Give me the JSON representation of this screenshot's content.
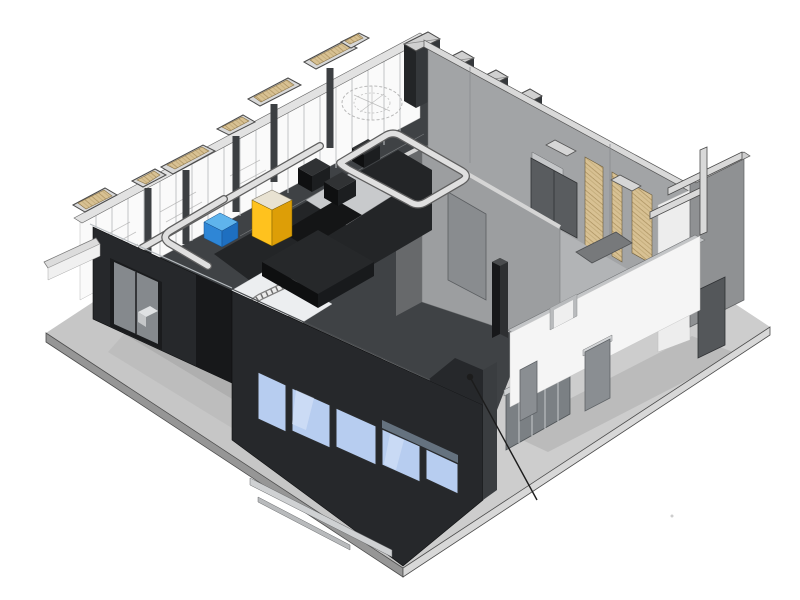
{
  "scene": {
    "aria_label": "3D axonometric cutaway rendering of a single-story commercial building interior with sectioned walls, ductwork, kitchen equipment and storefront",
    "annotation_label": ""
  },
  "colors": {
    "background": "#ffffff",
    "ground": "#c6c6c6",
    "ground_edge_front": "#969696",
    "ground_edge_right": "#d8d8d8",
    "ground_shadow": "#aaaaaa",
    "facade_dark": "#26282b",
    "facade_recess": "#17181a",
    "facade_base": "#191b1d",
    "storefront_glass_blue": "#b7cdf0",
    "glass_highlight": "#dce8fa",
    "window_glass_gray": "#85898d",
    "wall_gray_light": "#a2a4a6",
    "wall_gray_mid": "#9c9ea0",
    "wall_gray_dark": "#67696b",
    "wall_white": "#f5f5f5",
    "wall_top_band": "#c3c5c7",
    "wood_cut_fill": "#d8c193",
    "wood_cut_hatch": "#a98f5d",
    "frame_light": "#d8d8d8",
    "duct_light": "#e0e0e0",
    "duct_outline": "#5f5f5f",
    "floor_dark": "#232527",
    "floor_backroom": "#b2b4b6",
    "floor_dining_white": "#eceef0",
    "equipment_yellow": "#ffc21e",
    "equipment_yellow_dark": "#dd9e07",
    "equipment_blue": "#2e86d6",
    "equipment_blue_light": "#7cc0f0",
    "equipment_blue_top": "#5fb4ec",
    "door_gray": "#8a8e92",
    "leader": "#1c1c1c"
  }
}
